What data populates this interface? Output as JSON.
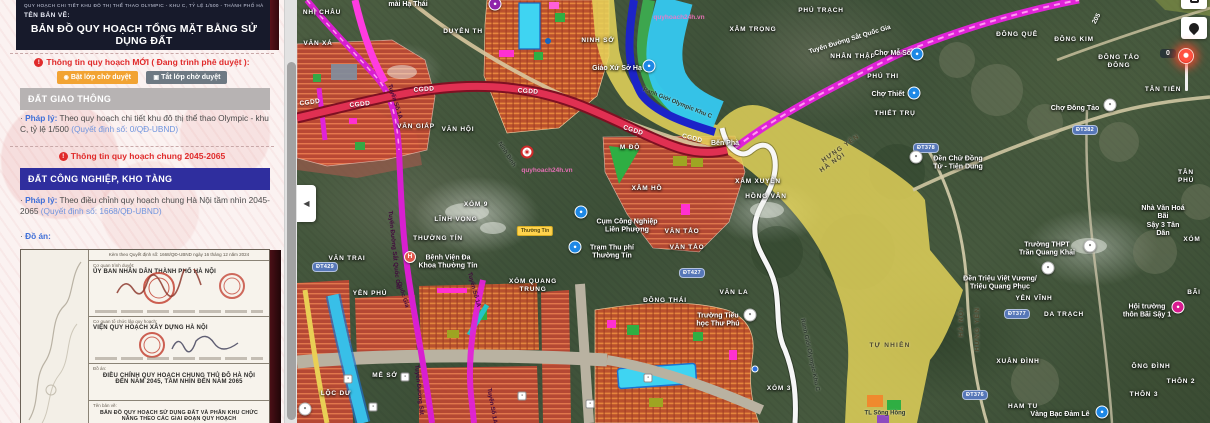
{
  "sidebar": {
    "doc_header": {
      "tiny_line": "QUY HOẠCH CHI TIẾT KHU ĐÔ THỊ THỂ THAO OLYMPIC - KHU C, TỶ LỆ 1/500 - THÀNH PHỐ HÀ NỘI",
      "ten_ban_ve_label": "TÊN BẢN VẼ:",
      "title": "BẢN ĐỒ QUY HOẠCH TỔNG MẶT BẰNG SỬ DỤNG ĐẤT"
    },
    "new_info": {
      "alert_glyph": "!",
      "heading": "Thông tin quy hoạch MỚI ( Đang trình phê duyệt ):",
      "btn_on_icon": "◉",
      "btn_on": "Bật lớp chờ duyệt",
      "btn_off_icon": "▣",
      "btn_off": "Tắt lớp chờ duyệt"
    },
    "section1": {
      "header": "ĐẤT GIAO THÔNG",
      "bullet": "·",
      "label": "Pháp lý:",
      "text": " Theo quy hoạch chi tiết khu đô thị thể thao Olympic - khu C, tỷ lệ 1/500 ",
      "link": "(Quyết định số: 0/QĐ-UBND)"
    },
    "chung_heading": "Thông tin quy hoạch chung 2045-2065",
    "section2": {
      "header": "ĐẤT CÔNG NGHIỆP, KHO TÀNG",
      "bullet": "·",
      "label": "Pháp lý:",
      "text": " Theo điều chỉnh quy hoạch chung Hà Nội tầm nhìn 2045-2065 ",
      "link": "(Quyết định số: 1668/QĐ-UBND)"
    },
    "do_an": {
      "bullet": "·",
      "label": "Đồ án:"
    },
    "document": {
      "issue_line": "Kèm theo Quyết định số: 1668/QĐ-UBND ngày 16 tháng 12 năm 2024",
      "approver_label": "Cơ quan trình duyệt:",
      "approver": "ỦY BAN NHÂN DÂN THÀNH PHỐ HÀ NỘI",
      "agency_label": "Cơ quan tổ chức lập quy hoạch:",
      "agency": "VIỆN QUY HOẠCH XÂY DỰNG HÀ NỘI",
      "project_label": "Đồ án:",
      "project": "ĐIỀU CHỈNH QUY HOẠCH CHUNG THỦ ĐÔ HÀ NỘI ĐẾN NĂM 2045, TẦM NHÌN ĐẾN NĂM 2065",
      "drawing_label": "Tên bản vẽ:",
      "drawing": "BẢN ĐỒ QUY HOẠCH SỬ DỤNG ĐẤT VÀ PHÂN KHU CHỨC NĂNG THEO CÁC GIAI ĐOẠN QUY HOẠCH"
    }
  },
  "map": {
    "controls": {
      "collapse_glyph": "◀",
      "marker_count": "0"
    },
    "watermark": "quyhoach24h.vn",
    "labels": [
      {
        "t": "NHỊ CHÂU",
        "x": 25,
        "y": 13
      },
      {
        "t": "VĂN XÁ",
        "x": 21,
        "y": 44
      },
      {
        "t": "DUYÊN TH",
        "x": 166,
        "y": 32
      },
      {
        "t": "NINH SỞ",
        "x": 301,
        "y": 41
      },
      {
        "t": "XÂM TRỌNG",
        "x": 456,
        "y": 30
      },
      {
        "t": "PHÚ TRẠCH",
        "x": 524,
        "y": 11
      },
      {
        "t": "NHÂN THẬP",
        "x": 556,
        "y": 57
      },
      {
        "t": "PHÚ THI",
        "x": 586,
        "y": 77
      },
      {
        "t": "THIẾT TRỤ",
        "x": 598,
        "y": 114
      },
      {
        "t": "ĐÔNG QUÊ",
        "x": 720,
        "y": 35
      },
      {
        "t": "ĐÔNG KIM",
        "x": 777,
        "y": 40
      },
      {
        "t": "ĐÔNG TẢO\nĐÔNG",
        "x": 822,
        "y": 62
      },
      {
        "t": "TÂN TIẾN",
        "x": 866,
        "y": 90
      },
      {
        "t": "TÂN PHÚ",
        "x": 889,
        "y": 177
      },
      {
        "t": "XÓM",
        "x": 895,
        "y": 240
      },
      {
        "t": "YÊN VĨNH",
        "x": 737,
        "y": 299
      },
      {
        "t": "DA TRẠCH",
        "x": 767,
        "y": 315
      },
      {
        "t": "BÃI",
        "x": 897,
        "y": 293
      },
      {
        "t": "XUÂN ĐÌNH",
        "x": 721,
        "y": 362
      },
      {
        "t": "ÔNG ĐÌNH",
        "x": 854,
        "y": 367
      },
      {
        "t": "THÔN 2",
        "x": 884,
        "y": 382
      },
      {
        "t": "THÔN 3",
        "x": 847,
        "y": 395
      },
      {
        "t": "HAM TU",
        "x": 726,
        "y": 407
      },
      {
        "t": "XÂM HỒ",
        "x": 350,
        "y": 189
      },
      {
        "t": "XÂM XUYÊN",
        "x": 461,
        "y": 182
      },
      {
        "t": "HỒNG VÂN",
        "x": 469,
        "y": 197
      },
      {
        "t": "M ĐỘ",
        "x": 333,
        "y": 148
      },
      {
        "t": "VĂN TẢO",
        "x": 385,
        "y": 232
      },
      {
        "t": "VĂN TẢO",
        "x": 390,
        "y": 248
      },
      {
        "t": "XÓM 9",
        "x": 179,
        "y": 205
      },
      {
        "t": "LĨNH VỌNG",
        "x": 159,
        "y": 220
      },
      {
        "t": "THƯỜNG TÍN",
        "x": 141,
        "y": 239
      },
      {
        "t": "VĂN TRAI",
        "x": 50,
        "y": 259
      },
      {
        "t": "XÓM QUANG\nTRUNG",
        "x": 236,
        "y": 286
      },
      {
        "t": "YÊN PHÚ",
        "x": 73,
        "y": 294
      },
      {
        "t": "MỄ SỞ",
        "x": 88,
        "y": 376
      },
      {
        "t": "LỘC DƯ",
        "x": 39,
        "y": 394
      },
      {
        "t": "ĐÔNG THÁI",
        "x": 368,
        "y": 301
      },
      {
        "t": "VĂN LA",
        "x": 437,
        "y": 293
      },
      {
        "t": "XÓM 3",
        "x": 482,
        "y": 389
      },
      {
        "t": "VĂN HỘI",
        "x": 161,
        "y": 130
      },
      {
        "t": "VĂN GIÁP",
        "x": 119,
        "y": 127
      },
      {
        "t": "TỰ NHIÊN",
        "x": 593,
        "y": 346,
        "c": "bd"
      },
      {
        "t": "mài Hạ Thái",
        "x": 111,
        "y": 5,
        "c": "poi"
      },
      {
        "t": "Giáo Xứ Sở Hạ",
        "x": 320,
        "y": 69,
        "c": "poi"
      },
      {
        "t": "Chợ Mễ Sở",
        "x": 596,
        "y": 54,
        "c": "poi"
      },
      {
        "t": "Chợ Thiết",
        "x": 591,
        "y": 95,
        "c": "poi"
      },
      {
        "t": "Chợ Đông Tảo",
        "x": 778,
        "y": 109,
        "c": "poi"
      },
      {
        "t": "Đền Chử Đồng\nTử - Tiên Dung",
        "x": 661,
        "y": 164,
        "c": "poi"
      },
      {
        "t": "Nhà Văn Hoá Bãi\nSậy 3 Tân Dân",
        "x": 866,
        "y": 222,
        "c": "poi"
      },
      {
        "t": "Trường THPT\nTrần Quang Khải",
        "x": 750,
        "y": 250,
        "c": "poi"
      },
      {
        "t": "Đền Triệu Việt Vương/\nTriệu Quang Phục",
        "x": 703,
        "y": 284,
        "c": "poi"
      },
      {
        "t": "Hội trường\nthôn Bãi Sậy 1",
        "x": 850,
        "y": 312,
        "c": "poi"
      },
      {
        "t": "Vàng Bạc Đảm Lê",
        "x": 763,
        "y": 415,
        "c": "poi"
      },
      {
        "t": "Cụm Công Nghiệp\nLiên Phượng",
        "x": 330,
        "y": 227,
        "c": "poi"
      },
      {
        "t": "Trạm Thu phí\nThường Tín",
        "x": 315,
        "y": 253,
        "c": "poi"
      },
      {
        "t": "Bệnh Viện Đa\nKhoa Thường Tín",
        "x": 151,
        "y": 263,
        "c": "poi"
      },
      {
        "t": "Trường Tiểu\nhọc Thư Phú",
        "x": 421,
        "y": 321,
        "c": "poi"
      },
      {
        "t": "Bến Phà",
        "x": 428,
        "y": 144,
        "c": "poi"
      },
      {
        "t": "HÀ NỘI",
        "x": 665,
        "y": 322,
        "c": "bd",
        "r": -90
      },
      {
        "t": "HƯNG YÊN",
        "x": 681,
        "y": 329,
        "c": "bd",
        "r": -90
      },
      {
        "t": "HƯNG YÊN",
        "x": 544,
        "y": 149,
        "c": "bd",
        "r": -35
      },
      {
        "t": "HÀ NỘI",
        "x": 536,
        "y": 163,
        "c": "bd",
        "r": -35
      },
      {
        "t": "Ranh Giới Olympic Khu C",
        "x": 380,
        "y": 104,
        "c": "rd",
        "r": 22
      },
      {
        "t": "Ranh Giới Olympic-Khu C",
        "x": 512,
        "y": 355,
        "c": "rd",
        "r": 78
      },
      {
        "t": "TL Sông Hồng",
        "x": 588,
        "y": 414,
        "c": "rd"
      },
      {
        "t": "205",
        "x": 800,
        "y": 19,
        "c": "wt",
        "r": -62
      },
      {
        "t": "Ninh Bình",
        "x": 209,
        "y": 155,
        "c": "rd",
        "r": 58
      },
      {
        "t": "Tuyến Đường Sắt Quốc Gia",
        "x": 553,
        "y": 40,
        "c": "wt",
        "r": -17
      },
      {
        "t": "Tuyến Đường Sắt Quốc Gia",
        "x": 96,
        "y": 250,
        "c": "rl",
        "r": 84
      },
      {
        "t": "Tuyến Đường Sắt",
        "x": 121,
        "y": 390,
        "c": "rl",
        "r": 84
      },
      {
        "t": "Tuyến Số 1A",
        "x": 97,
        "y": 102,
        "c": "rl",
        "r": 72
      },
      {
        "t": "Tuyến Số 1A",
        "x": 176,
        "y": 290,
        "c": "rl",
        "r": 75
      },
      {
        "t": "Tuyến Số 1A",
        "x": 194,
        "y": 406,
        "c": "rl",
        "r": 80
      },
      {
        "t": "Quốc Gia",
        "x": 105,
        "y": 295,
        "c": "rl",
        "r": 72
      },
      {
        "t": "CGDD",
        "x": 13,
        "y": 103,
        "c": "cg",
        "r": -8
      },
      {
        "t": "CGDD",
        "x": 63,
        "y": 105,
        "c": "cg",
        "r": -6
      },
      {
        "t": "CGDD",
        "x": 127,
        "y": 90,
        "c": "cg",
        "r": -4
      },
      {
        "t": "CGDD",
        "x": 231,
        "y": 92,
        "c": "cg",
        "r": 4
      },
      {
        "t": "CGDD",
        "x": 336,
        "y": 131,
        "c": "cg",
        "r": 18
      },
      {
        "t": "CGDD",
        "x": 395,
        "y": 139,
        "c": "cg",
        "r": 14
      },
      {
        "t": "quyhoach24h.vn",
        "x": 250,
        "y": 171,
        "c": "wm"
      },
      {
        "t": "quyhoach24h.vn",
        "x": 382,
        "y": 18,
        "c": "wm"
      },
      {
        "t": "Thường Tín",
        "x": 238,
        "y": 231,
        "c": "yb"
      }
    ],
    "badges": [
      {
        "t": "ĐT382",
        "x": 788,
        "y": 130
      },
      {
        "t": "ĐT378",
        "x": 629,
        "y": 148
      },
      {
        "t": "ĐT377",
        "x": 720,
        "y": 314
      },
      {
        "t": "ĐT376",
        "x": 678,
        "y": 395
      },
      {
        "t": "ĐT427",
        "x": 395,
        "y": 273
      },
      {
        "t": "ĐT429",
        "x": 28,
        "y": 267
      }
    ],
    "icons": [
      {
        "t": "c",
        "col": "#8e24aa",
        "x": 198,
        "y": 4,
        "n": "poi-icon-craft-village",
        "g": "●"
      },
      {
        "t": "c",
        "col": "#1e88e5",
        "x": 352,
        "y": 66,
        "n": "poi-icon-church",
        "g": "●"
      },
      {
        "t": "c",
        "col": "#1e88e5",
        "x": 620,
        "y": 54,
        "n": "poi-icon-market",
        "g": "●"
      },
      {
        "t": "c",
        "col": "#1e88e5",
        "x": 617,
        "y": 93,
        "n": "poi-icon-market",
        "g": "●"
      },
      {
        "t": "c",
        "col": "#1e88e5",
        "x": 284,
        "y": 212,
        "n": "poi-icon-industrial-cluster",
        "g": "●"
      },
      {
        "t": "c",
        "col": "#1e88e5",
        "x": 278,
        "y": 247,
        "n": "poi-icon-toll-station",
        "g": "●"
      },
      {
        "t": "c",
        "col": "#1e88e5",
        "x": 805,
        "y": 412,
        "n": "poi-icon-jewelry",
        "g": "●"
      },
      {
        "t": "w",
        "x": 813,
        "y": 105,
        "n": "poi-icon-market",
        "g": "●"
      },
      {
        "t": "w",
        "x": 619,
        "y": 157,
        "n": "poi-icon-temple",
        "g": "●"
      },
      {
        "t": "w",
        "x": 793,
        "y": 246,
        "n": "poi-icon-school",
        "g": "●"
      },
      {
        "t": "w",
        "x": 751,
        "y": 268,
        "n": "poi-icon-temple",
        "g": "●"
      },
      {
        "t": "w",
        "x": 453,
        "y": 315,
        "n": "poi-icon-school",
        "g": "●"
      },
      {
        "t": "c",
        "col": "#d81b8f",
        "x": 881,
        "y": 307,
        "n": "poi-icon-community-hall",
        "g": "●"
      },
      {
        "t": "h",
        "x": 113,
        "y": 257,
        "n": "hospital-icon",
        "g": "H"
      },
      {
        "t": "s",
        "x": 230,
        "y": 152,
        "n": "planning-marker-icon",
        "g": "◉"
      },
      {
        "t": "m",
        "x": 51,
        "y": 379,
        "n": "transit-icon",
        "g": "▪"
      },
      {
        "t": "m",
        "x": 76,
        "y": 407,
        "n": "transit-icon",
        "g": "▪"
      },
      {
        "t": "m",
        "x": 108,
        "y": 377,
        "n": "transit-icon",
        "g": "▪"
      },
      {
        "t": "m",
        "x": 225,
        "y": 396,
        "n": "transit-icon",
        "g": "▪"
      },
      {
        "t": "m",
        "x": 293,
        "y": 404,
        "n": "transit-icon",
        "g": "▪"
      },
      {
        "t": "m",
        "x": 351,
        "y": 378,
        "n": "transit-icon",
        "g": "▪"
      },
      {
        "t": "w",
        "x": 8,
        "y": 409,
        "n": "poi-icon",
        "g": "●"
      },
      {
        "t": "d",
        "x": 458,
        "y": 369,
        "n": "poi-icon"
      }
    ]
  },
  "colors": {
    "accent_red": "#e02b2b",
    "btn_orange": "#f2a333",
    "btn_gray": "#6e7983",
    "header_gray": "#b7b3b3",
    "header_navy": "#2f2e9e",
    "link_blue": "#3f6fd8",
    "zone_red": "#bf4733",
    "zone_yellow": "#e6d55a",
    "river_cyan": "#35c8f0",
    "rail_magenta": "#e023d8",
    "road_red": "#e03052"
  }
}
